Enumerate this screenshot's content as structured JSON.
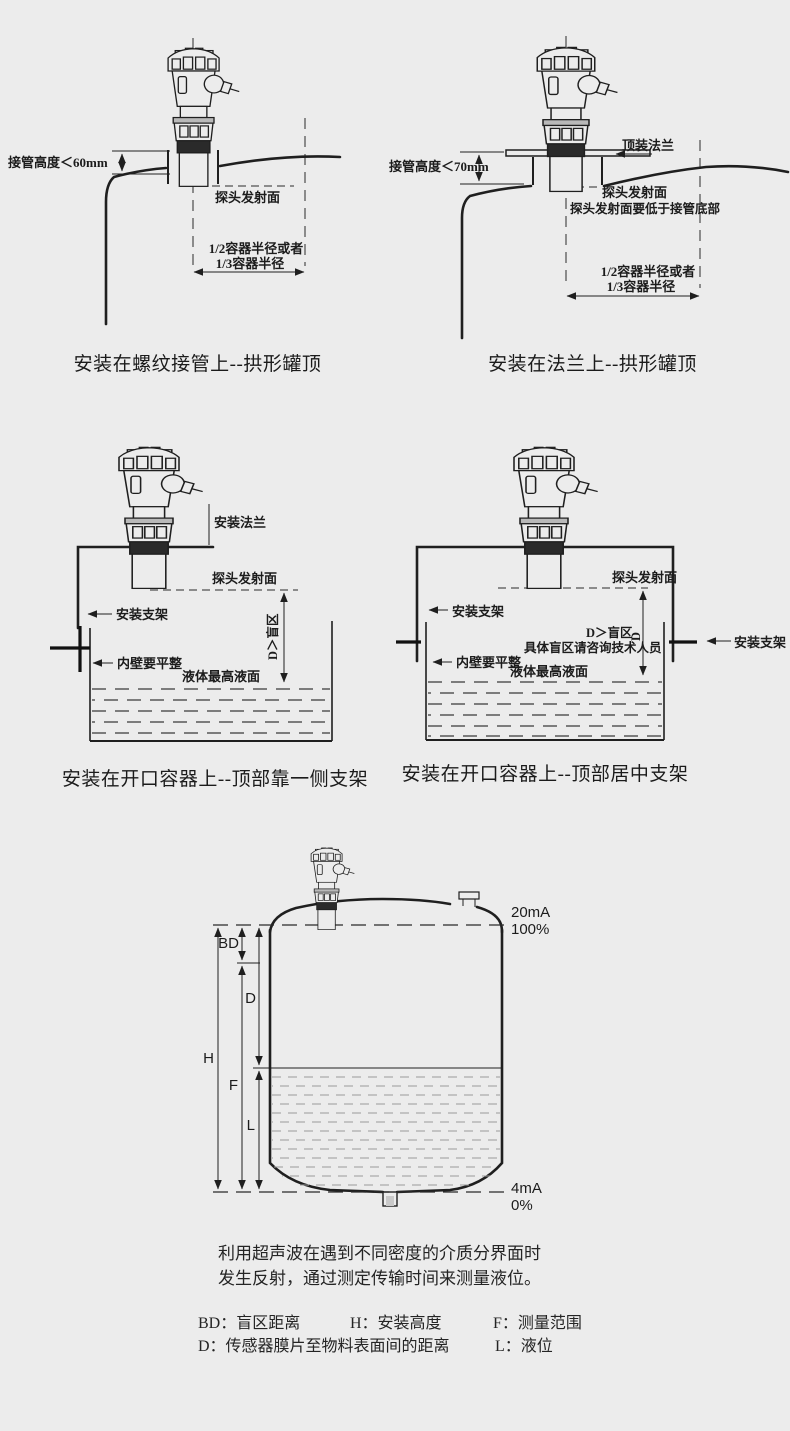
{
  "colors": {
    "background": "#ececec",
    "ink": "#1f1f1f"
  },
  "diagram1": {
    "caption": "安装在螺纹接管上--拱形罐顶",
    "pipe_height": "接管高度＜60mm",
    "probe_face": "探头发射面",
    "radius_line1": "1/2容器半径或者",
    "radius_line2": "1/3容器半径"
  },
  "diagram2": {
    "caption": "安装在法兰上--拱形罐顶",
    "top_flange": "顶装法兰",
    "pipe_height": "接管高度＜70mm",
    "probe_face": "探头发射面",
    "probe_note": "探头发射面要低于接管底部",
    "radius_line1": "1/2容器半径或者",
    "radius_line2": "1/3容器半径"
  },
  "diagram3": {
    "caption": "安装在开口容器上--顶部靠一侧支架",
    "mount_flange": "安装法兰",
    "probe_face": "探头发射面",
    "bracket": "安装支架",
    "blind_zone": "D＞盲区",
    "wall_note": "内壁要平整",
    "max_level": "液体最高液面"
  },
  "diagram4": {
    "caption": "安装在开口容器上--顶部居中支架",
    "probe_face": "探头发射面",
    "bracket_left": "安装支架",
    "bracket_right": "安装支架",
    "blind_zone": "D＞盲区",
    "blind_d": "D",
    "blind_note": "具体盲区请咨询技术人员",
    "wall_note": "内壁要平整",
    "max_level": "液体最高液面"
  },
  "diagram5": {
    "h": "H",
    "bd": "BD",
    "d": "D",
    "f": "F",
    "l": "L",
    "top_current": "20mA",
    "top_percent": "100%",
    "bottom_current": "4mA",
    "bottom_percent": "0%"
  },
  "description": {
    "line1": "利用超声波在遇到不同密度的介质分界面时",
    "line2": "发生反射，通过测定传输时间来测量液位。"
  },
  "legend": {
    "bd": "BD：盲区距离",
    "h": "H：安装高度",
    "f": "F：测量范围",
    "d": "D：传感器膜片至物料表面间的距离",
    "l": "L：液位"
  }
}
